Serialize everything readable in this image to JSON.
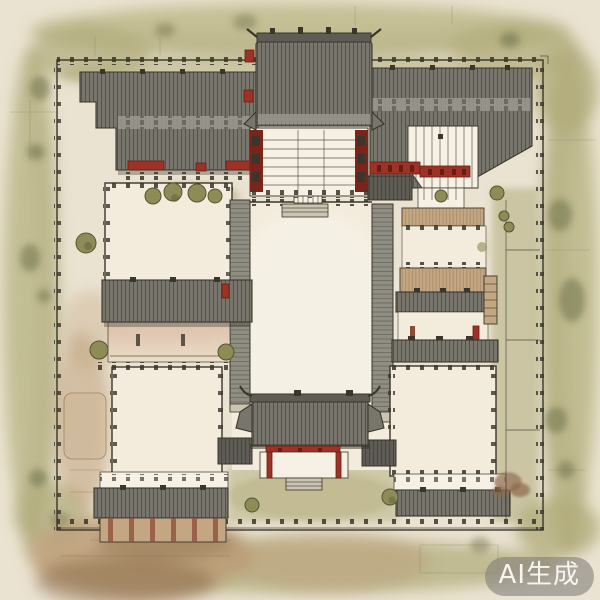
{
  "watermark": {
    "label": "AI生成"
  },
  "palette": {
    "paper": "#ebe3d2",
    "paper_light": "#f6f1e4",
    "courtyard": "#f3ecdd",
    "ink": "#3a362c",
    "roof": "#77756c",
    "roof_dark": "#5e5c54",
    "roof_line": "#2f2d27",
    "gallery": "#908e83",
    "veg": "#b1ad7c",
    "veg_pale": "#c9c59b",
    "veg_deep": "#666741",
    "tan": "#c3a783",
    "earth": "#bb9b75",
    "earth_deep": "#8a6a49",
    "red": "#9d3226",
    "red_dark": "#671d14",
    "pink": "#d9bca7",
    "pink_light": "#ecdcc6",
    "tree": "#8d8c57",
    "tree_dark": "#55552f",
    "step": "#cbc4b2",
    "eave_light": "#9b9990",
    "watermark_bg": "rgba(128,127,122,0.60)",
    "watermark_text": "#f7f5f0"
  }
}
